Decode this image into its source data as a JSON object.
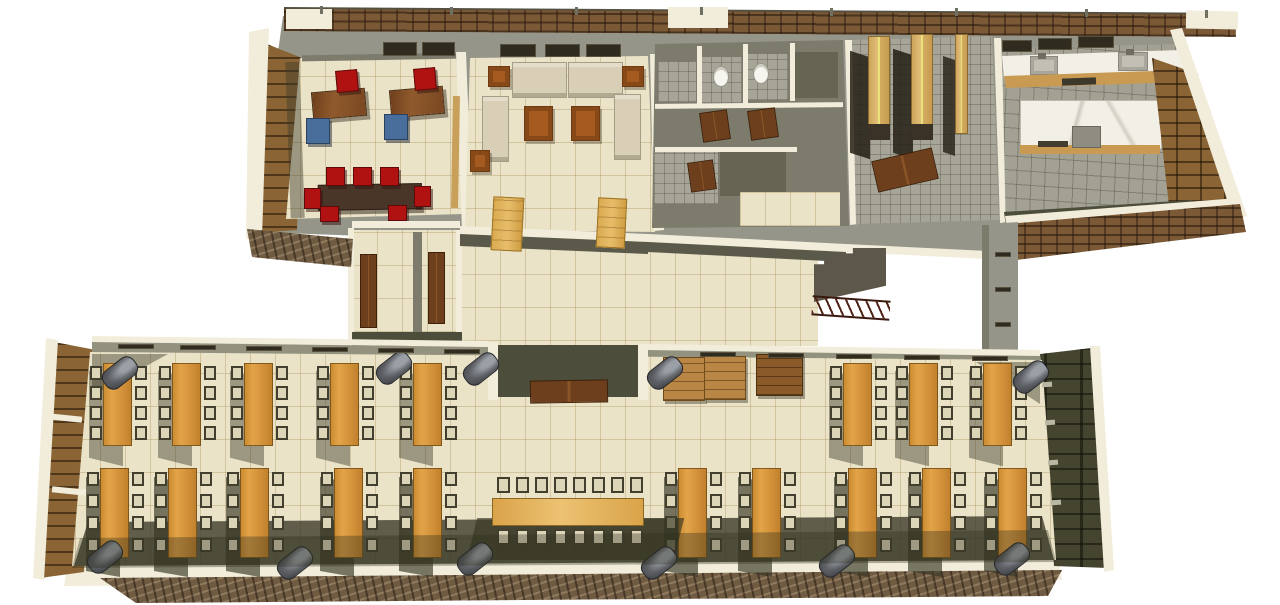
{
  "scene": {
    "description": "3D isometric cutaway rendering of a single-story building floor plan, viewed from above; no text labels visible",
    "style": "textured architectural 3D render on white background",
    "background_color": "#ffffff",
    "colors": {
      "floor_tile": "#eae3c8",
      "gray_tile": "#a7a598",
      "wall_light": "#96958a",
      "wall_mid": "#7c7b6c",
      "wall_dark": "#5a594a",
      "wall_cap": "#f1edda",
      "olive_dark": "#4c4d3a",
      "wood_table": "#dd9a3f",
      "wood_bench": "#d9a94f",
      "wood_shelf": "#d9b06a",
      "desk": "#7d4a22",
      "meeting_table": "#4a3629",
      "door": "#6e3f1d",
      "chair_red": "#b01212",
      "chair_blue": "#4a6e9c",
      "chair_seat": "#ddd5b8",
      "chair_frame": "#423f2e",
      "sofa": "#d8cfb6",
      "marble": "#f2efe6",
      "brick": "#7b5836",
      "louver_wood": "#8a6434",
      "bin": "#5d6065",
      "counter_wood": "#c89a52"
    },
    "wings": [
      {
        "name": "upper-wing",
        "rooms": [
          {
            "name": "office",
            "floor": "beige ceramic tile",
            "furniture": [
              "2 wooden desks",
              "2 red task chairs",
              "2 blue guest chairs",
              "dark meeting table with 7 red chairs"
            ],
            "windows": 2
          },
          {
            "name": "lounge",
            "floor": "beige ceramic tile",
            "furniture": [
              "2 three-seat sofas",
              "2 side sofas",
              "2 wooden coffee tables",
              "2 corner end tables",
              "1 small side table",
              "2 wooden benches"
            ],
            "windows": 3
          },
          {
            "name": "restrooms",
            "floor": "gray tile",
            "furniture": [
              "2 toilets",
              "3 brown stall mats"
            ],
            "stalls": 4
          },
          {
            "name": "storage",
            "floor": "gray tile",
            "furniture": [
              "3 tall wooden shelving units",
              "double door laid open on floor"
            ]
          },
          {
            "name": "kitchen",
            "floor": "gray pavers",
            "furniture": [
              "marble counter with 2 sinks",
              "marble island with cooktop",
              "wood cabinet fronts",
              "louvered pantry wall"
            ],
            "windows": 3
          }
        ]
      },
      {
        "name": "connector-hall",
        "features": [
          "beige tiled hall",
          "2 interior brown doors",
          "2 light wooden benches",
          "dark staircase with truss railing",
          "wall column with vent slits"
        ]
      },
      {
        "name": "dining-hall",
        "features": [
          "8 vertical dining tables in upper row",
          "10 vertical dining tables in lower row",
          "1 long banquet table with 16 chairs",
          "8 chairs per vertical table",
          "trash bins along walls",
          "entry vestibule with brown mat",
          "3 wooden sideboards",
          "louvered window wall left",
          "dark louvered wall right",
          "stone foundation band"
        ]
      }
    ]
  },
  "layout_data": {
    "dining": {
      "top_tables_x": [
        103,
        172,
        244,
        330,
        413,
        843,
        909,
        983
      ],
      "top_table": {
        "y": 363,
        "w": 29,
        "h": 83,
        "chair_dy": [
          3,
          23,
          43,
          63
        ]
      },
      "bottom_tables_x": [
        100,
        168,
        240,
        334,
        413,
        678,
        752,
        848,
        922,
        998
      ],
      "bottom_table": {
        "y": 468,
        "w": 29,
        "h": 90,
        "chair_dy": [
          4,
          26,
          48,
          70
        ]
      },
      "long_table": {
        "x": 492,
        "y": 498,
        "w": 152,
        "h": 28,
        "chairs": 8,
        "chair_start_x": 497,
        "chair_step": 19,
        "top_chair_y": 477,
        "bottom_chair_y": 529
      },
      "bins_top": [
        [
          101,
          362
        ],
        [
          375,
          357
        ],
        [
          462,
          358
        ],
        [
          646,
          362
        ],
        [
          1012,
          366
        ]
      ],
      "bins_bottom": [
        [
          86,
          546
        ],
        [
          276,
          552
        ],
        [
          456,
          548
        ],
        [
          640,
          552
        ],
        [
          818,
          550
        ],
        [
          993,
          548
        ]
      ],
      "top_band_slits_left": [
        [
          118,
          344
        ],
        [
          180,
          345
        ],
        [
          246,
          346
        ],
        [
          312,
          347
        ],
        [
          378,
          348
        ],
        [
          444,
          349
        ]
      ],
      "top_band_slits_right": [
        [
          700,
          352
        ],
        [
          768,
          353
        ],
        [
          836,
          354
        ],
        [
          904,
          355
        ],
        [
          972,
          356
        ]
      ]
    },
    "roof_posts": [
      [
        320,
        6
      ],
      [
        450,
        7
      ],
      [
        575,
        7
      ],
      [
        700,
        7
      ],
      [
        830,
        8
      ],
      [
        955,
        8
      ],
      [
        1085,
        9
      ],
      [
        1205,
        10
      ]
    ],
    "right_band_tabs": [
      [
        1042,
        382
      ],
      [
        1045,
        420
      ],
      [
        1048,
        460
      ],
      [
        1051,
        500
      ]
    ],
    "left_band_caps": [
      [
        48,
        415
      ],
      [
        52,
        488
      ]
    ]
  }
}
